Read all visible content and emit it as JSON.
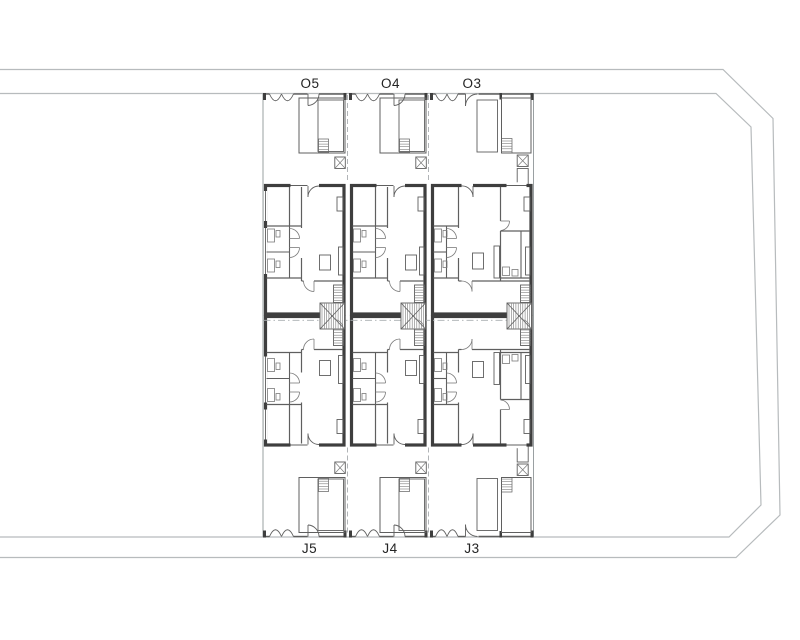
{
  "drawing": {
    "units_top": [
      {
        "label": "O5"
      },
      {
        "label": "O4"
      },
      {
        "label": "O3"
      }
    ],
    "units_bottom": [
      {
        "label": "J5"
      },
      {
        "label": "J4"
      },
      {
        "label": "J3"
      }
    ],
    "colors": {
      "background": "#ffffff",
      "wall": "#3e3e3e",
      "partition": "#5f5f5f",
      "fixture": "#7a7a7a",
      "boundary": "#9aa0a2",
      "road": "#b7bbbd",
      "dashed": "#a9adb0",
      "label_text": "#242424"
    }
  }
}
